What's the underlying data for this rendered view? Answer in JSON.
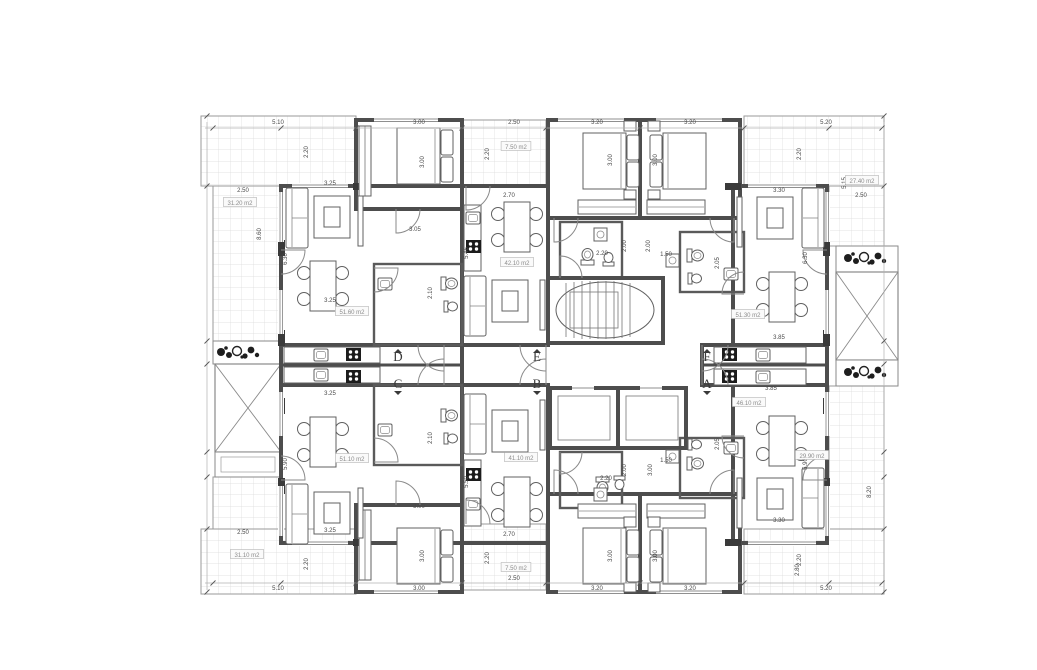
{
  "meta": {
    "drawing_type": "apartment-building-floor-plan",
    "units_visible": [
      "D",
      "C",
      "E",
      "B",
      "F",
      "A"
    ]
  },
  "colors": {
    "wall": "#4d4d4d",
    "thin_line": "#8a8a8a",
    "grid": "#dadada",
    "text": "#4a4a4a",
    "paper": "#ffffff"
  },
  "corridor_labels": [
    {
      "letter": "D",
      "x": 398,
      "y": 361,
      "marker": "up"
    },
    {
      "letter": "C",
      "x": 398,
      "y": 388,
      "marker": "down"
    },
    {
      "letter": "E",
      "x": 537,
      "y": 361,
      "marker": "up"
    },
    {
      "letter": "B",
      "x": 537,
      "y": 388,
      "marker": "down"
    },
    {
      "letter": "F",
      "x": 707,
      "y": 361,
      "marker": "up"
    },
    {
      "letter": "A",
      "x": 707,
      "y": 388,
      "marker": "down"
    }
  ],
  "area_labels": [
    {
      "text": "31.20 m2",
      "x": 240,
      "y": 204
    },
    {
      "text": "7.50 m2",
      "x": 516,
      "y": 148
    },
    {
      "text": "27.40 m2",
      "x": 862,
      "y": 182
    },
    {
      "text": "51.60 m2",
      "x": 352,
      "y": 313
    },
    {
      "text": "42.10 m2",
      "x": 517,
      "y": 264
    },
    {
      "text": "51.30 m2",
      "x": 748,
      "y": 316
    },
    {
      "text": "51.10 m2",
      "x": 352,
      "y": 460
    },
    {
      "text": "41.10 m2",
      "x": 521,
      "y": 459
    },
    {
      "text": "46.10 m2",
      "x": 749,
      "y": 404
    },
    {
      "text": "31.10 m2",
      "x": 247,
      "y": 556
    },
    {
      "text": "29.90 m2",
      "x": 812,
      "y": 457
    },
    {
      "text": "7.50 m2",
      "x": 516,
      "y": 569
    }
  ],
  "dim_labels": [
    {
      "text": "5.10",
      "x": 278,
      "y": 124,
      "rot": 0
    },
    {
      "text": "3.00",
      "x": 419,
      "y": 124,
      "rot": 0
    },
    {
      "text": "2.50",
      "x": 514,
      "y": 124,
      "rot": 0
    },
    {
      "text": "3.20",
      "x": 597,
      "y": 124,
      "rot": 0
    },
    {
      "text": "3.20",
      "x": 690,
      "y": 124,
      "rot": 0
    },
    {
      "text": "5.20",
      "x": 826,
      "y": 124,
      "rot": 0
    },
    {
      "text": "5.10",
      "x": 278,
      "y": 590,
      "rot": 0
    },
    {
      "text": "3.00",
      "x": 419,
      "y": 590,
      "rot": 0
    },
    {
      "text": "2.50",
      "x": 514,
      "y": 580,
      "rot": 0
    },
    {
      "text": "3.20",
      "x": 597,
      "y": 590,
      "rot": 0
    },
    {
      "text": "3.20",
      "x": 690,
      "y": 590,
      "rot": 0
    },
    {
      "text": "5.20",
      "x": 826,
      "y": 590,
      "rot": 0
    },
    {
      "text": "2.20",
      "x": 308,
      "y": 152,
      "rot": 1
    },
    {
      "text": "2.20",
      "x": 489,
      "y": 154,
      "rot": 1
    },
    {
      "text": "3.00",
      "x": 424,
      "y": 162,
      "rot": 1
    },
    {
      "text": "3.00",
      "x": 612,
      "y": 160,
      "rot": 1
    },
    {
      "text": "3.00",
      "x": 657,
      "y": 160,
      "rot": 1
    },
    {
      "text": "2.20",
      "x": 801,
      "y": 154,
      "rot": 1
    },
    {
      "text": "2.20",
      "x": 308,
      "y": 564,
      "rot": 1
    },
    {
      "text": "2.20",
      "x": 489,
      "y": 558,
      "rot": 1
    },
    {
      "text": "3.00",
      "x": 424,
      "y": 556,
      "rot": 1
    },
    {
      "text": "3.00",
      "x": 612,
      "y": 556,
      "rot": 1
    },
    {
      "text": "3.00",
      "x": 657,
      "y": 556,
      "rot": 1
    },
    {
      "text": "2.20",
      "x": 801,
      "y": 560,
      "rot": 1
    },
    {
      "text": "2.50",
      "x": 243,
      "y": 192,
      "rot": 0
    },
    {
      "text": "8.60",
      "x": 261,
      "y": 234,
      "rot": 1
    },
    {
      "text": "2.50",
      "x": 243,
      "y": 534,
      "rot": 0
    },
    {
      "text": "2.50",
      "x": 861,
      "y": 197,
      "rot": 0
    },
    {
      "text": "5.15",
      "x": 846,
      "y": 183,
      "rot": 1
    },
    {
      "text": "8.20",
      "x": 871,
      "y": 492,
      "rot": 1
    },
    {
      "text": "2.80",
      "x": 799,
      "y": 570,
      "rot": 1
    },
    {
      "text": "3.25",
      "x": 330,
      "y": 185,
      "rot": 0
    },
    {
      "text": "6.30",
      "x": 287,
      "y": 259,
      "rot": 1
    },
    {
      "text": "3.25",
      "x": 330,
      "y": 302,
      "rot": 0
    },
    {
      "text": "3.25",
      "x": 330,
      "y": 395,
      "rot": 0
    },
    {
      "text": "5.90",
      "x": 287,
      "y": 464,
      "rot": 1
    },
    {
      "text": "3.25",
      "x": 330,
      "y": 532,
      "rot": 0
    },
    {
      "text": "2.70",
      "x": 509,
      "y": 197,
      "rot": 0
    },
    {
      "text": "5.46",
      "x": 468,
      "y": 253,
      "rot": 1
    },
    {
      "text": "2.70",
      "x": 509,
      "y": 536,
      "rot": 0
    },
    {
      "text": "5.50",
      "x": 468,
      "y": 482,
      "rot": 1
    },
    {
      "text": "3.30",
      "x": 779,
      "y": 192,
      "rot": 0
    },
    {
      "text": "6.30",
      "x": 807,
      "y": 258,
      "rot": 1
    },
    {
      "text": "3.85",
      "x": 779,
      "y": 339,
      "rot": 0
    },
    {
      "text": "3.85",
      "x": 771,
      "y": 390,
      "rot": 0
    },
    {
      "text": "5.90",
      "x": 807,
      "y": 464,
      "rot": 1
    },
    {
      "text": "3.30",
      "x": 779,
      "y": 522,
      "rot": 0
    },
    {
      "text": "2.20",
      "x": 602,
      "y": 255,
      "rot": 0
    },
    {
      "text": "2.00",
      "x": 626,
      "y": 246,
      "rot": 1
    },
    {
      "text": "2.00",
      "x": 650,
      "y": 246,
      "rot": 1
    },
    {
      "text": "1.50",
      "x": 666,
      "y": 256,
      "rot": 0
    },
    {
      "text": "2.05",
      "x": 719,
      "y": 263,
      "rot": 1
    },
    {
      "text": "2.20",
      "x": 606,
      "y": 480,
      "rot": 0
    },
    {
      "text": "2.00",
      "x": 626,
      "y": 470,
      "rot": 1
    },
    {
      "text": "3.00",
      "x": 652,
      "y": 470,
      "rot": 1
    },
    {
      "text": "1.50",
      "x": 666,
      "y": 462,
      "rot": 0
    },
    {
      "text": "2.05",
      "x": 719,
      "y": 444,
      "rot": 1
    },
    {
      "text": "3.05",
      "x": 415,
      "y": 231,
      "rot": 0
    },
    {
      "text": "2.10",
      "x": 432,
      "y": 293,
      "rot": 1
    },
    {
      "text": "2.10",
      "x": 432,
      "y": 438,
      "rot": 1
    },
    {
      "text": "3.00",
      "x": 419,
      "y": 508,
      "rot": 0
    }
  ]
}
